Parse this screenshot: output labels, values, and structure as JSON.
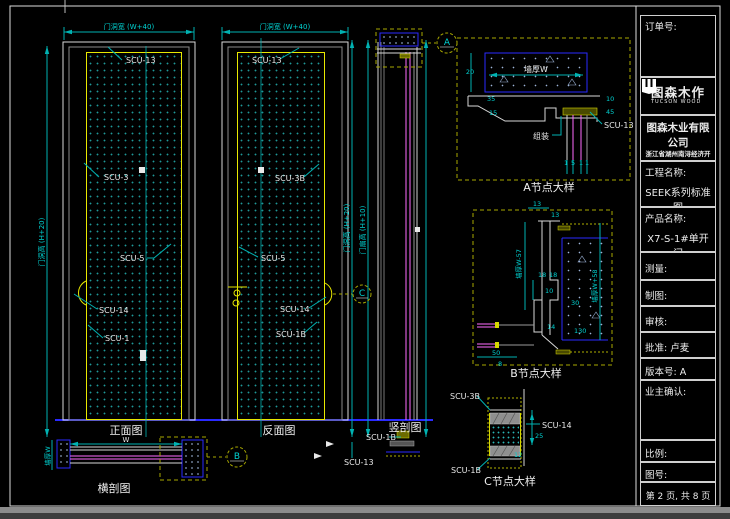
{
  "views": {
    "front": {
      "caption": "正面图",
      "width_dim": "门洞宽 (W+40)",
      "height_dim": "门洞高 (H+20)",
      "parts": [
        "SCU-13",
        "SCU-3",
        "SCU-5",
        "SCU-14",
        "SCU-1"
      ]
    },
    "back": {
      "caption": "反面图",
      "width_dim": "门洞宽 (W+40)",
      "parts": [
        "SCU-13",
        "SCU-3B",
        "SCU-5",
        "SCU-14",
        "SCU-1B"
      ]
    },
    "vsection": {
      "caption": "竖剖图",
      "opening_dim": "门洞高 (H+20)",
      "leaf_dim": "门扇高 (H+10)",
      "bottom_parts": [
        "SCU-1B",
        "SCU-13"
      ]
    },
    "hsection": {
      "caption": "横剖图",
      "width_dim": "W",
      "wall_dim": "墙厚W"
    },
    "detail_a": {
      "caption": "A节点大样",
      "marker": "A",
      "wall_dim": "墙厚W",
      "assembly_label": "组装",
      "part_label": "SCU-13",
      "dims": [
        "20",
        "35",
        "15",
        "10",
        "45",
        "1",
        "5",
        "1",
        "1"
      ]
    },
    "detail_b": {
      "caption": "B节点大样",
      "marker": "B",
      "left_dim": "墙厚W-57",
      "right_dim": "墙厚W+58",
      "dims": [
        "13",
        "13",
        "18",
        "18",
        "10",
        "14",
        "30",
        "130",
        "50",
        "8"
      ]
    },
    "detail_c": {
      "caption": "C节点大样",
      "marker": "C",
      "parts": [
        "SCU-3B",
        "SCU-1B",
        "SCU-14"
      ],
      "dims": [
        "25",
        "12"
      ]
    }
  },
  "title_block": {
    "order_label": "订单号:",
    "logo": {
      "name": "图森木作",
      "subtitle": "TUCSON WOOD"
    },
    "company_name": "图森木业有限公司",
    "company_address_1": "浙江省湖州南浔经济开发区",
    "company_address_2": "强盛路1号",
    "project_label": "工程名称:",
    "project_value": "SEEK系列标准图",
    "product_label": "产品名称:",
    "product_value": "X7-S-1#单开门",
    "survey_label": "测量:",
    "draft_label": "制图:",
    "review_label": "审核:",
    "approve_label": "批准: 卢麦",
    "version_label": "版本号:   A",
    "owner_label": "业主确认:",
    "scale_label": "比例:",
    "drawing_no_label": "图号:",
    "page_info": "第 2 页, 共 8 页"
  }
}
